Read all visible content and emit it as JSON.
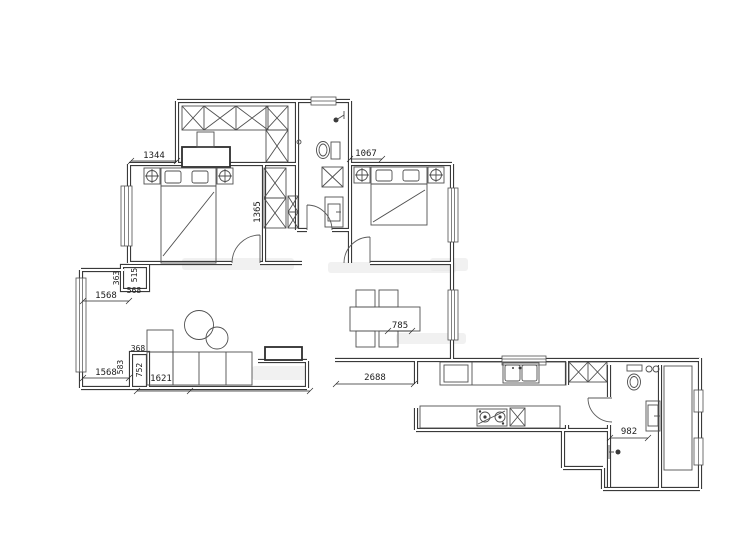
{
  "canvas": {
    "width": 740,
    "height": 555,
    "background": "#ffffff"
  },
  "colors": {
    "wall": "#3a3a3a",
    "furniture": "#4f4f4f",
    "dimension_text": "#1c1c1c",
    "watermark": "#e7e7e7"
  },
  "dims": {
    "d1344": "1344",
    "d1067": "1067",
    "d1365": "1365",
    "d363": "363",
    "d515": "515",
    "d568": "568",
    "d1568a": "1568",
    "d1568b": "1568",
    "d368": "368",
    "d583": "583",
    "d752": "752",
    "d1621": "1621",
    "d785": "785",
    "d2688": "2688",
    "d982": "982"
  },
  "fixtures": [
    "wardrobe-x-cabinets",
    "desk",
    "desk-chair",
    "double-bed-left",
    "double-bed-right",
    "nightstand-lamp-symbol",
    "pillows",
    "toilet",
    "shower-head",
    "floor-drain",
    "laundry-basket",
    "vanity-sink",
    "l-shaped-sofa",
    "round-coffee-tables",
    "side-table",
    "dining-table",
    "dining-chairs",
    "kitchen-counter",
    "double-basin-sink",
    "refrigerator",
    "gas-stove",
    "bathroom-toilet",
    "washbasin",
    "shower-symbol",
    "duct-shaft",
    "window",
    "door-swing"
  ]
}
